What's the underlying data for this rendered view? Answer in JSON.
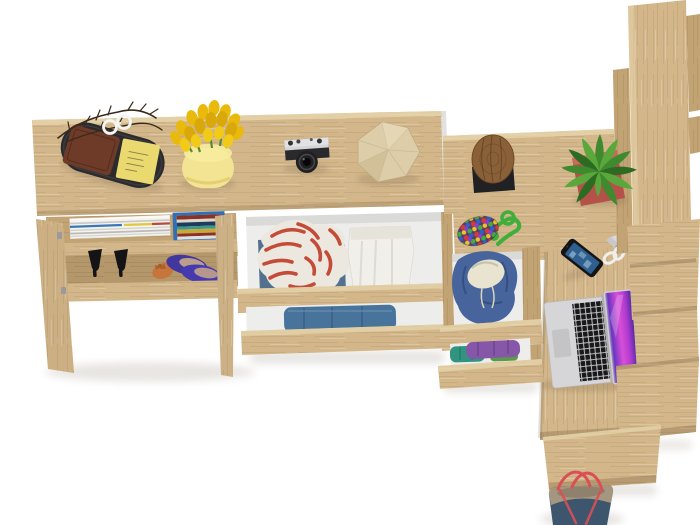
{
  "scene": {
    "type": "3d-product-render",
    "view": "top-down",
    "description": "Top view of a Sonoma oak furniture set on a white background: sideboard with open doors showing shoes, magazines and books, styled with a valet tray, tulips, camera and paper gem; chest with open drawers of folded clothes; narrow drawer unit with a blue hoodie; oak desk with laptop, smartphone, scissors, plant, stool and bead charm; tall wardrobe columns, stepped shelf slabs, a bench and a navy tote bag"
  },
  "colors": {
    "background": "#ffffff",
    "oak": "#d3b78b",
    "oakMid": "#c2a474",
    "oakEdge": "#e7d6ac",
    "interior": "#ededeb",
    "trayBlack": "#2b2b2e",
    "wallet": "#6e3b28",
    "stickyNote": "#ead96e",
    "branch": "#3a2a1c",
    "tulipYellow": "#e9b90c",
    "vase": "#f2e492",
    "cameraSilver": "#d5d5d7",
    "cameraBlack": "#202022",
    "gem": "#ddcda9",
    "gemLine": "#bfa87e",
    "stoolWood": "#8a6038",
    "stoolBase": "#212124",
    "plantGreen": "#3f8a2e",
    "plantLight": "#5aa83c",
    "pot": "#b4524a",
    "ropeGreen": "#3fae3a",
    "phoneBody": "#141417",
    "phoneScreen": "#2e5f8e",
    "scissors": "#efefed",
    "laptopSilver": "#d6d6d8",
    "laptopKeys": "#19191b",
    "screenPink": "#d84fd8",
    "screenViolet": "#6a35c2",
    "shirtRed": "#c44b38",
    "shirtWhite": "#ece7df",
    "denim": "#53718e",
    "pantsWhite": "#f1efe9",
    "jeans": "#48749c",
    "hoodie": "#47649c",
    "hoodieLining": "#e9e4cf",
    "clothPurple": "#8657a8",
    "clothTeal": "#31947f",
    "heels": "#141416",
    "flatPurple": "#41379e",
    "flatOrange": "#c6763d",
    "bagNavy": "#3d566e",
    "bagTrim": "#a5977f",
    "bagStrap": "#d94f55",
    "bookBlue": "#2e6fb5",
    "magWhite": "#f4f3f0"
  },
  "objects": [
    {
      "name": "sideboard",
      "label": "Oak sideboard with open doors"
    },
    {
      "name": "valet-tray",
      "label": "Black tray with leather wallet, sticky notes, twig branches and round glasses"
    },
    {
      "name": "tulips",
      "label": "Yellow tulips in a pale yellow vase"
    },
    {
      "name": "camera",
      "label": "Silver retro film camera with black lens"
    },
    {
      "name": "paper-gem",
      "label": "Faceted paper gem ornament"
    },
    {
      "name": "magazines",
      "label": "Stack of magazines on shelf"
    },
    {
      "name": "books",
      "label": "Row of books in a blue holder"
    },
    {
      "name": "high-heels",
      "label": "Pair of black high-heel shoes"
    },
    {
      "name": "flats",
      "label": "Purple ballet flats and an orange flat"
    },
    {
      "name": "chest-drawer-top",
      "label": "Open drawer with red striped shirt and white trousers"
    },
    {
      "name": "chest-drawer-bottom",
      "label": "Open drawer with folded blue jeans"
    },
    {
      "name": "hoodie-drawer",
      "label": "Open drawer with blue hoodie"
    },
    {
      "name": "knit-drawer",
      "label": "Open drawer with purple and teal knitwear"
    },
    {
      "name": "stool",
      "label": "Round log stool on black base"
    },
    {
      "name": "plant",
      "label": "Green plant in a red square pot"
    },
    {
      "name": "keychain",
      "label": "Multicolour bead charm with green cord"
    },
    {
      "name": "smartphone",
      "label": "Smartphone lying on the desk"
    },
    {
      "name": "scissors",
      "label": "White-handled scissors"
    },
    {
      "name": "laptop",
      "label": "Open laptop with purple wallpaper"
    },
    {
      "name": "desk",
      "label": "Oak desk return"
    },
    {
      "name": "wardrobe",
      "label": "Tall oak wardrobe columns"
    },
    {
      "name": "shelf-stack",
      "label": "Stepped oak shelf slabs"
    },
    {
      "name": "bench",
      "label": "Oak bench slab"
    },
    {
      "name": "tote-bag",
      "label": "Navy tote bag with khaki trim and red straps"
    }
  ]
}
